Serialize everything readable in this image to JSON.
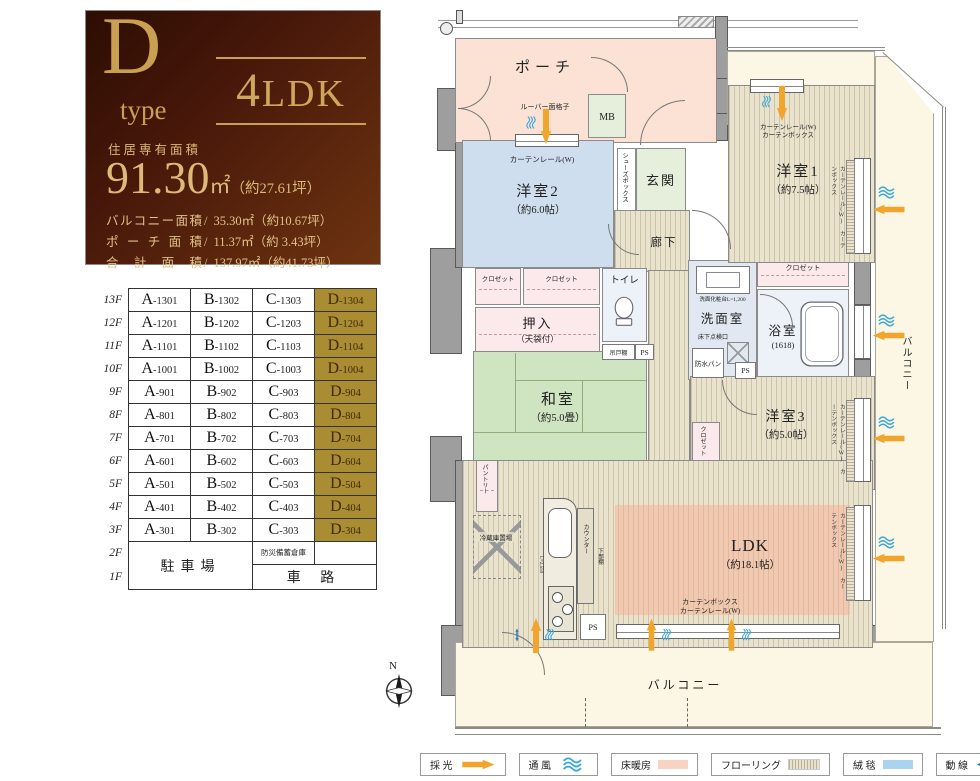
{
  "info_box": {
    "type_letter": "D",
    "type_word": "type",
    "layout": "4LDK",
    "area_caption": "住居専有面積",
    "area_value": "91.30",
    "area_unit": "㎡",
    "area_tsubo": "（約27.61坪）",
    "detail_rows": [
      {
        "label": "バルコニー面積",
        "slash": "/",
        "value": "35.30㎡（約10.67坪）"
      },
      {
        "label": "ポーチ面積",
        "slash": "/",
        "value": "11.37㎡（約 3.43坪）"
      },
      {
        "label": "合計面積",
        "slash": "/",
        "value": "137.97㎡（約41.73坪）"
      }
    ]
  },
  "floor_table": {
    "floors": [
      {
        "floor": "13F",
        "units": [
          "A-1301",
          "B-1302",
          "C-1303",
          "D-1304"
        ]
      },
      {
        "floor": "12F",
        "units": [
          "A-1201",
          "B-1202",
          "C-1203",
          "D-1204"
        ]
      },
      {
        "floor": "11F",
        "units": [
          "A-1101",
          "B-1102",
          "C-1103",
          "D-1104"
        ]
      },
      {
        "floor": "10F",
        "units": [
          "A-1001",
          "B-1002",
          "C-1003",
          "D-1004"
        ]
      },
      {
        "floor": "9F",
        "units": [
          "A-901",
          "B-902",
          "C-903",
          "D-904"
        ]
      },
      {
        "floor": "8F",
        "units": [
          "A-801",
          "B-802",
          "C-803",
          "D-804"
        ]
      },
      {
        "floor": "7F",
        "units": [
          "A-701",
          "B-702",
          "C-703",
          "D-704"
        ]
      },
      {
        "floor": "6F",
        "units": [
          "A-601",
          "B-602",
          "C-603",
          "D-604"
        ]
      },
      {
        "floor": "5F",
        "units": [
          "A-501",
          "B-502",
          "C-503",
          "D-504"
        ]
      },
      {
        "floor": "4F",
        "units": [
          "A-401",
          "B-402",
          "C-403",
          "D-404"
        ]
      },
      {
        "floor": "3F",
        "units": [
          "A-301",
          "B-302",
          "C-303",
          "D-304"
        ]
      }
    ],
    "f2": "2F",
    "f1": "1F",
    "parking": "駐車場",
    "storage": "防災備蓄倉庫",
    "driveway": "車 路"
  },
  "plan": {
    "compass_n": "N",
    "labels": {
      "porch": "ポーチ",
      "mb": "MB",
      "genkan": "玄関",
      "shoes": "シューズボックス",
      "rouka": "廊下",
      "y2": "洋室2",
      "y2s": "（約6.0帖）",
      "y1": "洋室1",
      "y1s": "（約7.5帖）",
      "y3": "洋室3",
      "y3s": "（約5.0帖）",
      "washitsu": "和室",
      "washitsus": "（約5.0畳）",
      "ldk": "LDK",
      "ldks": "（約18.1帖）",
      "oshiire": "押入",
      "oshiires": "（天袋付）",
      "closet": "クロゼット",
      "toilet": "トイレ",
      "tsuridana": "吊戸棚",
      "ps": "PS",
      "senmen": "洗面室",
      "vanity": "洗面化粧台L=1,200",
      "tenken": "床下点検口",
      "bousui": "防水パン",
      "bath": "浴室",
      "baths": "(1618)",
      "pantry": "パントリー",
      "fridge": "冷蔵庫置場",
      "counter_len": "L=2,550",
      "counter": "カウンター",
      "shitadana": "下部棚",
      "louver": "ルーバー面格子",
      "curtain_w": "カーテンレール(W)",
      "curtain_b": "カーテンボックス",
      "balcony": "バルコニー"
    }
  },
  "legend": {
    "items": [
      {
        "label": "採 光"
      },
      {
        "label": "通 風"
      },
      {
        "label": "床暖房"
      },
      {
        "label": "フローリング"
      },
      {
        "label": "絨 毯"
      },
      {
        "label": "動 線"
      }
    ]
  }
}
